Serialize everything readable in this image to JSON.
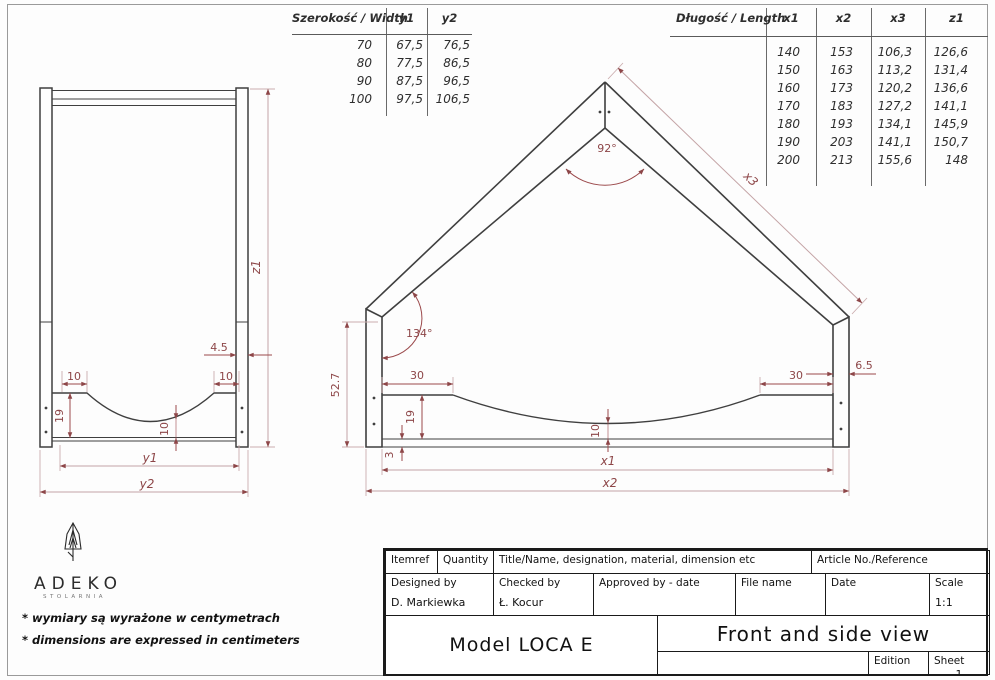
{
  "colors": {
    "line": "#3f3f3f",
    "dim_text": "#8d4648",
    "dim_line_dark": "#9b494b",
    "dim_line_light": "#c4a4a6"
  },
  "width_table": {
    "title": "Szerokość / Width",
    "columns": [
      "y1",
      "y2"
    ],
    "rows": [
      [
        "70",
        "67,5",
        "76,5"
      ],
      [
        "80",
        "77,5",
        "86,5"
      ],
      [
        "90",
        "87,5",
        "96,5"
      ],
      [
        "100",
        "97,5",
        "106,5"
      ]
    ]
  },
  "length_table": {
    "title": "Długość / Length",
    "columns": [
      "x1",
      "x2",
      "x3",
      "z1"
    ],
    "rows": [
      [
        "",
        "140",
        "153",
        "106,3",
        "126,6"
      ],
      [
        "",
        "150",
        "163",
        "113,2",
        "131,4"
      ],
      [
        "",
        "160",
        "173",
        "120,2",
        "136,6"
      ],
      [
        "",
        "170",
        "183",
        "127,2",
        "141,1"
      ],
      [
        "",
        "180",
        "193",
        "134,1",
        "145,9"
      ],
      [
        "",
        "190",
        "203",
        "141,1",
        "150,7"
      ],
      [
        "",
        "200",
        "213",
        "155,6",
        "148"
      ]
    ]
  },
  "front_view": {
    "dims": {
      "z1": "z1",
      "y1": "y1",
      "y2": "y2",
      "post_width": "4.5",
      "flat_left": "10",
      "flat_right": "10",
      "board_height": "19",
      "curve_depth": "10"
    }
  },
  "side_view": {
    "dims": {
      "apex_angle": "92°",
      "eave_angle": "134°",
      "height": "52.7",
      "flat_left": "30",
      "flat_right": "30",
      "post_width": "6.5",
      "board_height": "19",
      "curve_depth": "10",
      "rail_thickness": "3",
      "x1": "x1",
      "x2": "x2",
      "x3": "x3"
    }
  },
  "logo": {
    "name": "ADEKO",
    "subtitle": "STOLARNIA"
  },
  "notes": {
    "line1": "* wymiary są wyrażone w centymetrach",
    "line2": "* dimensions are expressed in centimeters"
  },
  "title_block": {
    "itemref": "Itemref",
    "quantity": "Quantity",
    "title_name": "Title/Name, designation, material, dimension etc",
    "article": "Article No./Reference",
    "designed_by": "Designed by",
    "designed_value": "D. Markiewka",
    "checked_by": "Checked by",
    "checked_value": "Ł. Kocur",
    "approved_by": "Approved by - date",
    "file_name": "File name",
    "date": "Date",
    "scale": "Scale",
    "scale_value": "1:1",
    "model": "Model LOCA E",
    "view_title": "Front and side view",
    "edition": "Edition",
    "sheet": "Sheet",
    "sheet_value": "1"
  }
}
